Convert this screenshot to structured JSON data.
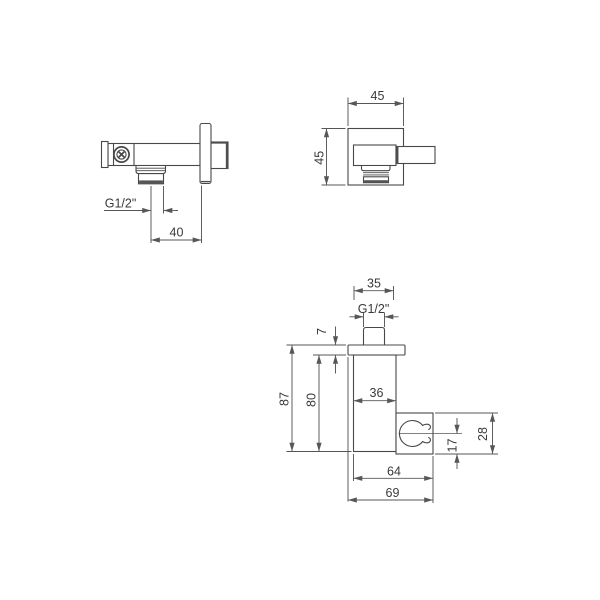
{
  "colors": {
    "line": "#484848",
    "dimension_line": "#575757",
    "label_text": "#3a3a3a",
    "background": "#ffffff"
  },
  "views": {
    "outlet_side_view": {
      "thread": "G1/2\"",
      "depth_to_wall": "40"
    },
    "outlet_front_view": {
      "width": "45",
      "height": "45"
    },
    "holder_side_view": {
      "top_width": "35",
      "thread": "G1/2\"",
      "flange_thickness": "7",
      "overall_height": "87",
      "body_height": "80",
      "body_width": "36",
      "clamp_offset": "17",
      "clamp_height": "28",
      "depth_body": "64",
      "depth_overall": "69"
    }
  }
}
